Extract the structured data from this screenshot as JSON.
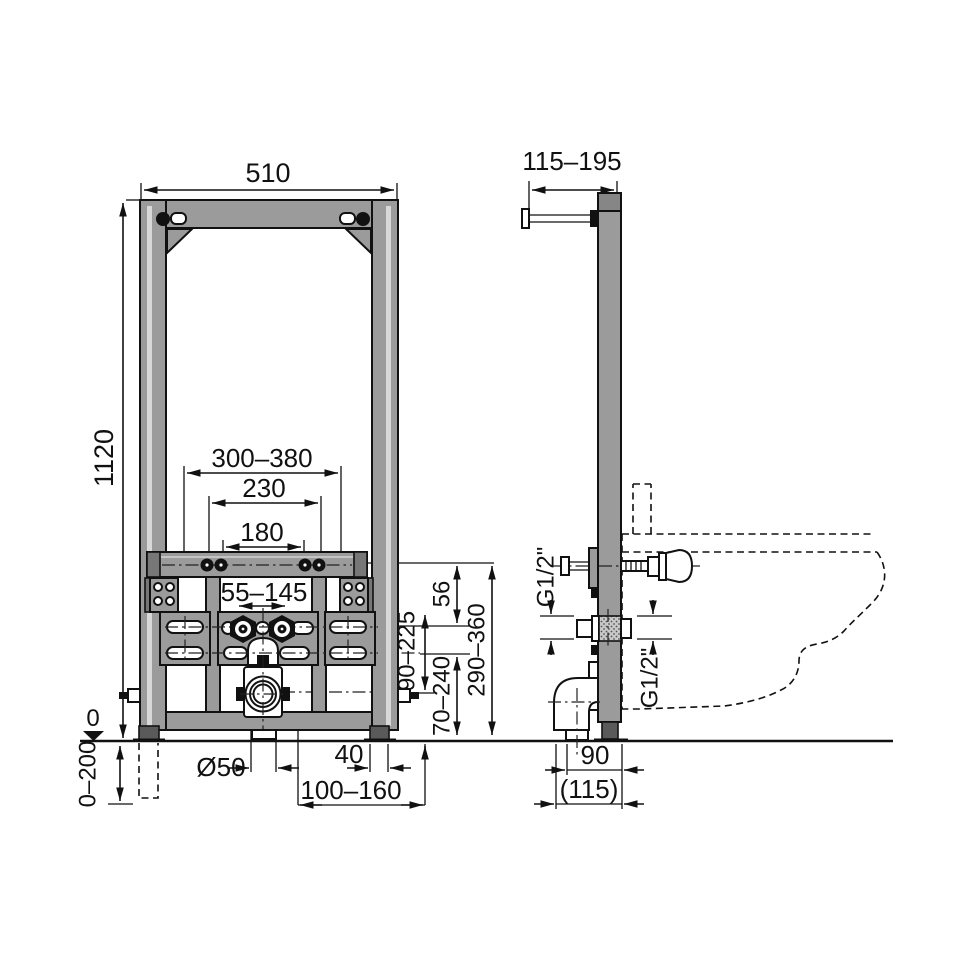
{
  "drawing": {
    "front_view": {
      "frame_width": "510",
      "frame_height": "1120",
      "stud_range": "300–380",
      "stud_outer_spacing": "230",
      "stud_inner_spacing": "180",
      "water_spacing": "55–145",
      "stud_to_water": "56",
      "drain_height_range": "90–225",
      "outlet_height_range": "70–240",
      "stud_height_range": "290–360",
      "floor_datum": "0",
      "feet_adjustment": "0–200",
      "drain_diameter": "Ø50",
      "foot_width": "40",
      "outlet_offset_range": "100–160"
    },
    "side_view": {
      "wall_distance_range": "115–195",
      "water_thread_left": "G1/2\"",
      "water_thread_right": "G1/2\"",
      "frame_depth": "90",
      "depth_with_elbow": "(115)"
    }
  }
}
